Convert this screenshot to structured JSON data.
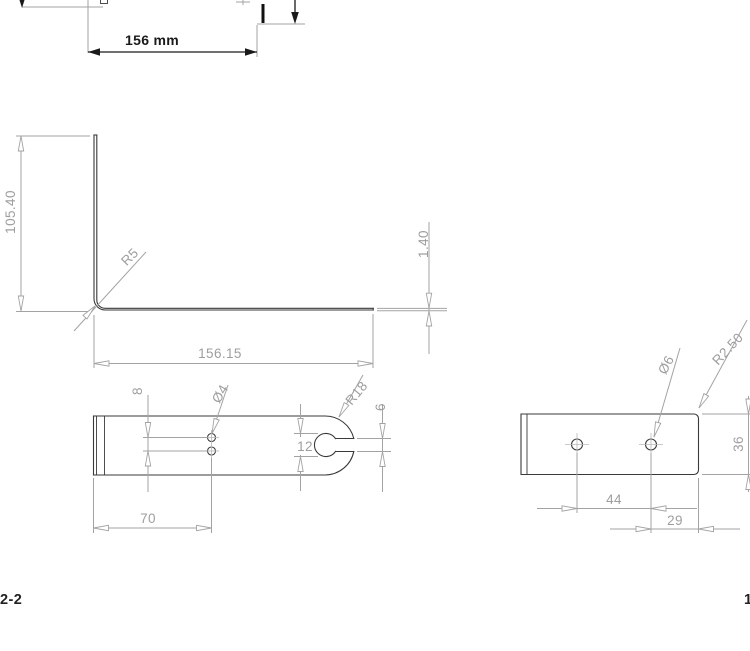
{
  "colors": {
    "background": "#ffffff",
    "outline": "#3a3a3a",
    "dimension": "#a3a3a3",
    "annotation": "#1a1a1a"
  },
  "views": {
    "top": {
      "width_dim": "156 mm"
    },
    "side": {
      "height_dim": "105.40",
      "bend_radius_dim": "R5",
      "length_dim": "156.15",
      "thickness_dim": "1.40"
    },
    "plan": {
      "hole_pitch_dim": "8",
      "hole_diameter_dim": "Ø4",
      "end_radius_dim": "R18",
      "slot_circle_dim": "12",
      "slot_width_dim": "6",
      "hole_position_dim": "70"
    },
    "end": {
      "hole_diameter_dim": "Ø6",
      "corner_radius_dim": "R2.50",
      "width_dim": "36",
      "hole_pitch_dim": "44",
      "edge_distance_dim": "29"
    }
  },
  "labels": {
    "bottom_left": "2-2",
    "bottom_right": "1"
  }
}
